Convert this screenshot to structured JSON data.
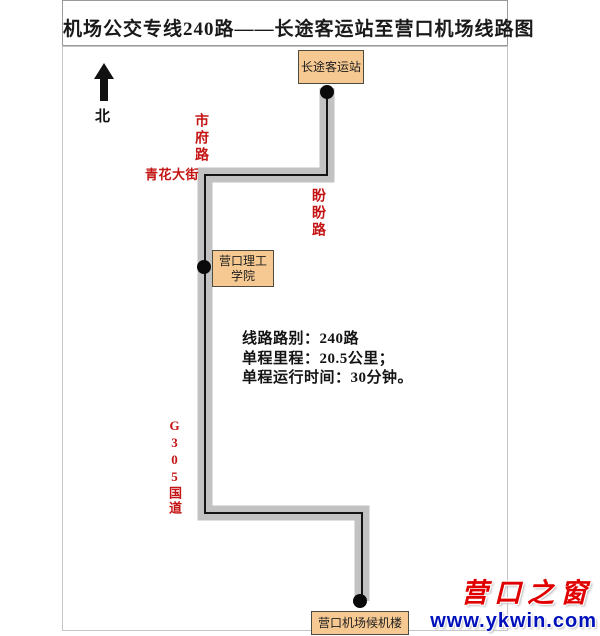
{
  "page": {
    "title": "机场公交专线240路——长途客运站至营口机场线路图"
  },
  "map": {
    "north_label": "北",
    "stations": {
      "start": "长途客运站",
      "middle_line1": "营口理工",
      "middle_line2": "学院",
      "end": "营口机场候机楼"
    },
    "roads": {
      "shifu": "市府路",
      "qinghua": "青花大街",
      "panpan": "盼盼路",
      "g305": "G305国道"
    },
    "info": {
      "line1": "线路路别：240路",
      "line2": "单程里程：20.5公里；",
      "line3": "单程运行时间：30分钟。"
    }
  },
  "watermark": {
    "site_name": "营口之窗",
    "site_url": "www.ykwin.com"
  },
  "colors": {
    "route_band": "#c2c2c2",
    "route_line": "#141414",
    "stop_dot": "#0a0a0a",
    "north_arrow": "#111111",
    "station_fill": "#f6c992",
    "road_label_red": "#c41414",
    "logo_red": "#e00000",
    "logo_blue": "#0011bb"
  }
}
